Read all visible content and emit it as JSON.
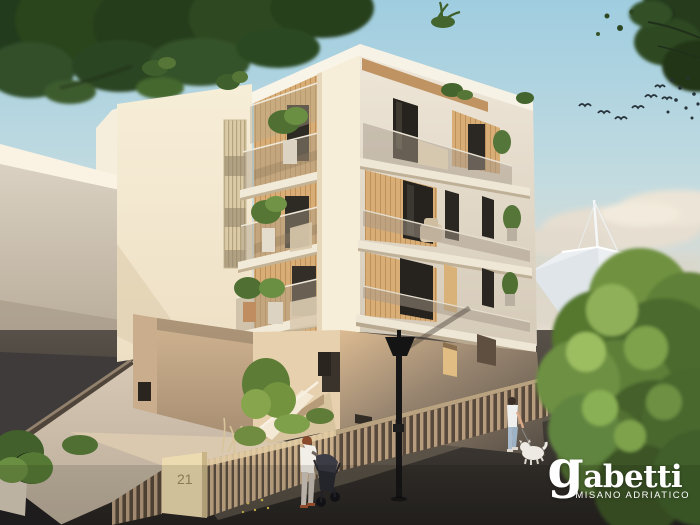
{
  "scene": {
    "type": "architectural-render",
    "house_number": "21"
  },
  "branding": {
    "logo_text": "gabetti",
    "tagline": "MISANO ADRIATICO",
    "logo_color": "#ffffff"
  },
  "palette": {
    "sky_top": "#9fcde0",
    "sky_horizon": "#e5ded0",
    "facade_sunlit": "#f6ecd6",
    "facade_shaded": "#ddd3c1",
    "wood_accent": "#d2a873",
    "ground_floor_shadow": "#60574c",
    "street": "#2a2724",
    "pavement": "#cfc2b0",
    "foliage_dark": "#2c4321",
    "foliage_light": "#9cbd60",
    "lamp_black": "#161616"
  }
}
